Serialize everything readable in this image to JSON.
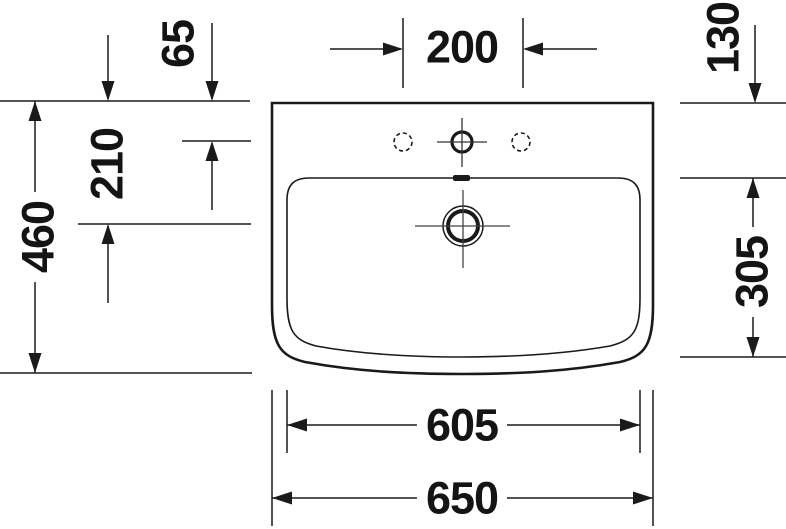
{
  "drawing_type": "washbasin plan view technical drawing",
  "line_color": "#1a1a1a",
  "dimensions": {
    "rim_to_faucet_centerline": "65",
    "faucet_hole_spacing": "200",
    "rear_ledge_depth": "130",
    "rim_to_drain_centerline": "210",
    "overall_depth": "460",
    "bowl_depth": "305",
    "bowl_width": "605",
    "overall_width": "650"
  }
}
